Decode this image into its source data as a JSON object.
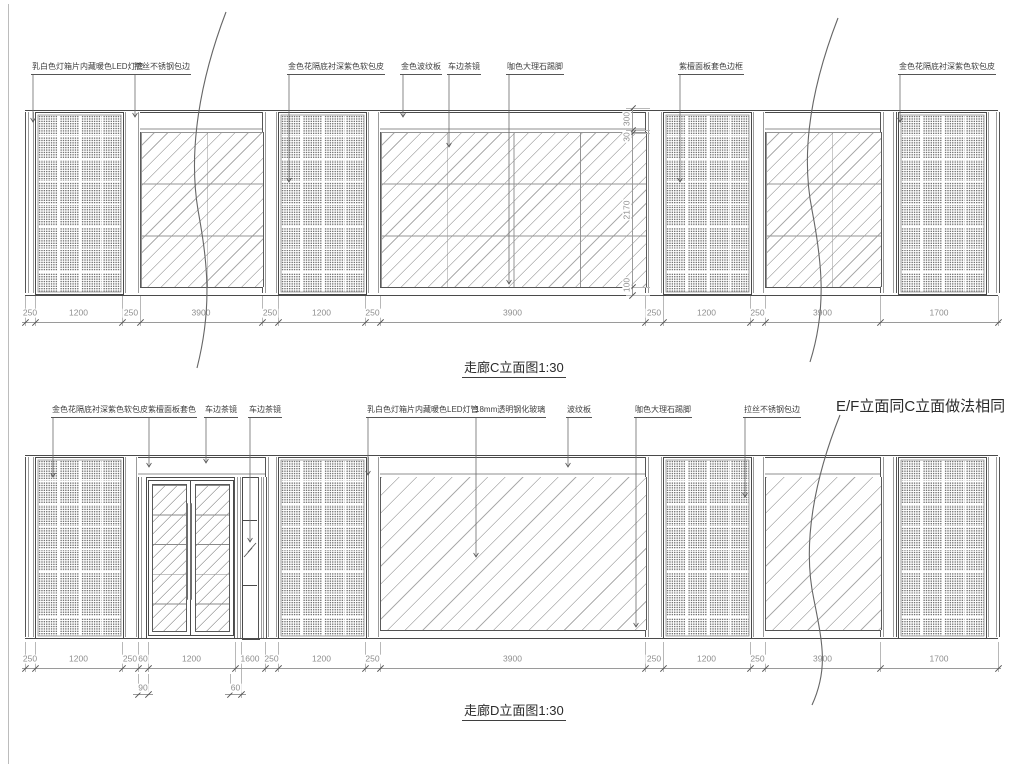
{
  "titles": {
    "top": "走廊C立面图1:30",
    "bottom": "走廊D立面图1:30",
    "note": "E/F立面同C立面做法相同"
  },
  "labels_top": [
    "乳白色灯箱片内藏暖色LED灯管",
    "拉丝不锈钢包边",
    "金色花隔底衬深紫色软包皮",
    "金色波纹板",
    "车边茶镜",
    "咖色大理石踢脚",
    "紫檀面板套色边框",
    "金色花隔底衬深紫色软包皮"
  ],
  "labels_bottom": [
    "金色花隔底衬深紫色软包皮",
    "紫檀面板套色",
    "车边茶镜",
    "车边茶镜",
    "乳白色灯箱片内藏暖色LED灯管",
    "18mm透明钢化玻璃",
    "波纹板",
    "咖色大理石踢脚",
    "拉丝不锈钢包边"
  ],
  "dims_top_h": [
    "250",
    "1200",
    "250",
    "3900",
    "250",
    "1200",
    "250",
    "3900",
    "250",
    "1200",
    "250",
    "3900",
    "1700"
  ],
  "dims_top_v": [
    "300",
    "30",
    "2170",
    "100"
  ],
  "dims_bottom_h": [
    "250",
    "1200",
    "250",
    "60",
    "1200",
    "1600",
    "250",
    "1200",
    "250",
    "3900",
    "250",
    "1200",
    "250",
    "3900",
    "1700"
  ],
  "dims_bottom_sub": [
    "90",
    "60"
  ],
  "colors": {
    "line": "#4a4a4a",
    "dim_text": "#8e8e8e",
    "label_text": "#3f3f3f",
    "background": "#ffffff"
  }
}
